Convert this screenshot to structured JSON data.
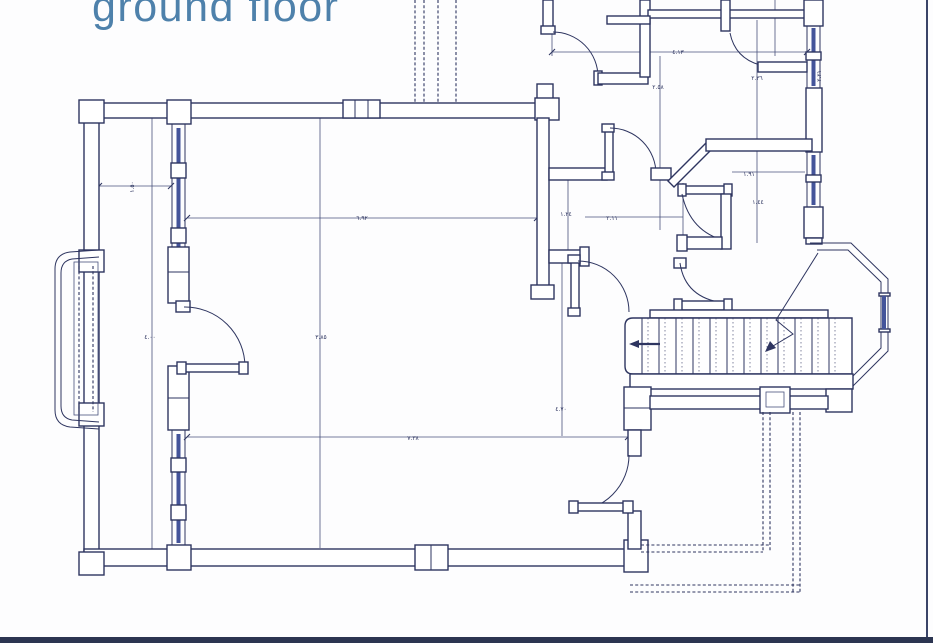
{
  "title": "ground floor",
  "colors": {
    "line": "#2e3560",
    "title_accent": "#4e81ab",
    "glass": "#44549a",
    "border_bar": "#2c3551",
    "background": "#fdfdfe"
  },
  "dims": [
    {
      "text": "٤.١٣"
    },
    {
      "text": "٢.٥٨"
    },
    {
      "text": "٢.٣٦"
    },
    {
      "text": "١.٩١"
    },
    {
      "text": "١.٤٤"
    },
    {
      "text": "٦.٩٢"
    },
    {
      "text": "١.٢٤"
    },
    {
      "text": "٢.١١"
    },
    {
      "text": "٤.٠٠"
    },
    {
      "text": "٣.٨٥"
    },
    {
      "text": "٤.٧٠"
    },
    {
      "text": "٧.٣٨"
    },
    {
      "text": "١.٥٠"
    },
    {
      "text": "٢.٢١"
    }
  ]
}
